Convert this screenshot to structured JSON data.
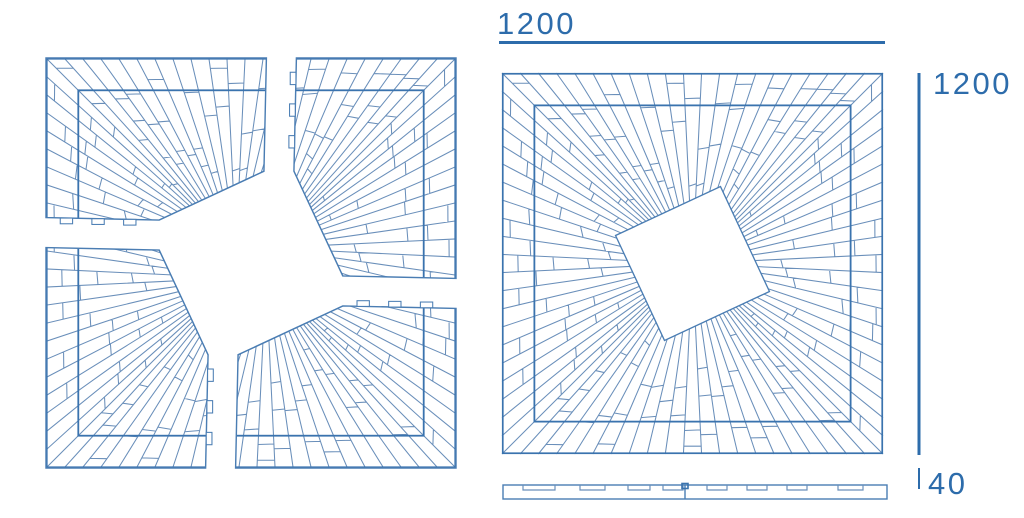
{
  "page": {
    "background": "#ffffff"
  },
  "colors": {
    "ray_line": "#6a8fba",
    "frame_line": "#3a73ae",
    "outline_line": "#4a7db3",
    "dimension": "#2d6cab"
  },
  "dimensions": {
    "width_label": "1200",
    "height_label": "1200",
    "thickness_label": "40"
  },
  "pattern": {
    "panel_units": 400,
    "rays_per_side": 21,
    "inner_frame_inset": 34,
    "center_square_radius": 86,
    "center_square_rotation_deg": 20,
    "cut_offset_units": 232,
    "explode_gap": 15,
    "joint_seed": 7,
    "tab_fractions": [
      0.18,
      0.46,
      0.74
    ]
  },
  "views": {
    "exploded": {
      "x": 61,
      "y": 73,
      "scale": 0.95
    },
    "assembled": {
      "x": 502,
      "y": 73,
      "scale": 0.9525
    },
    "profile": {
      "x": 503,
      "y": 485,
      "width": 384,
      "height": 14,
      "seam_x": 685,
      "grooves": [
        [
          523,
          555
        ],
        [
          580,
          605
        ],
        [
          628,
          650
        ],
        [
          663,
          683
        ],
        [
          707,
          727
        ],
        [
          747,
          767
        ],
        [
          787,
          807
        ],
        [
          838,
          863
        ]
      ]
    }
  },
  "dimension_marks": {
    "top_line": {
      "x1": 499,
      "y": 42.5,
      "x2": 885
    },
    "right_line": {
      "x": 919,
      "y1": 73,
      "y2": 455
    },
    "thickness_tick": {
      "x": 919,
      "y1": 468,
      "y2": 489
    }
  }
}
